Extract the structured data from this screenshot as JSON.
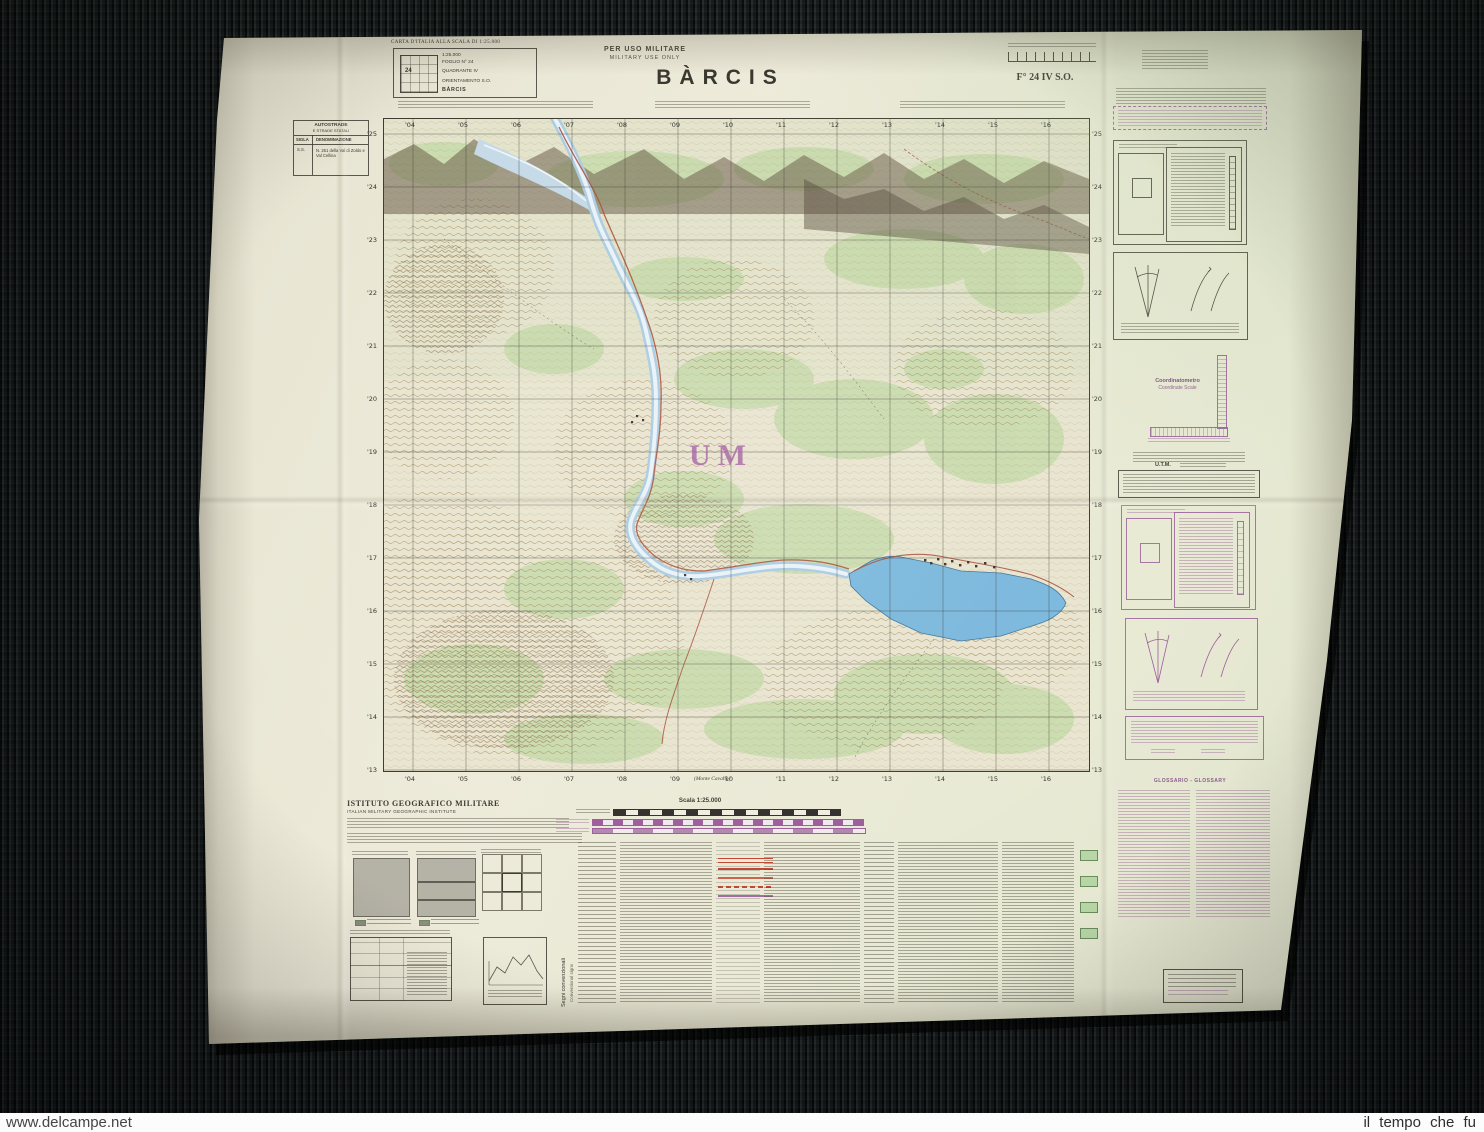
{
  "watermarks": {
    "left": "www.delcampe.net",
    "right": "il tempo che fu"
  },
  "header": {
    "carta_line": "CARTA D'ITALIA ALLA SCALA DI 1:25.000",
    "box_lines": [
      "1:25.000",
      "FOGLIO N° 24",
      "QUADRANTE IV",
      "ORIENTAMENTO S.O.",
      "BÀRCIS"
    ],
    "diagram_number": "24",
    "military_it": "PER USO MILITARE",
    "military_en": "MILITARY USE ONLY",
    "title": "BÀRCIS",
    "sheet_code": "F° 24 IV S.O."
  },
  "roads_box": {
    "title": "AUTOSTRADE",
    "subtitle": "E STRADE STATALI",
    "col1": "SIGLA",
    "col2": "DENOMINAZIONE",
    "row_sigla": "S.S.",
    "row_name": "N. 251 della Val di Zoldo e Val Cellina"
  },
  "map": {
    "zone_letters": "UM",
    "eastings": [
      "'04",
      "'05",
      "'06",
      "'07",
      "'08",
      "'09",
      "'10",
      "'11",
      "'12",
      "'13",
      "'14",
      "'15",
      "'16"
    ],
    "northings": [
      "'25",
      "'24",
      "'23",
      "'22",
      "'21",
      "'20",
      "'19",
      "'18",
      "'17",
      "'16",
      "'15",
      "'14",
      "'13"
    ],
    "adjoining_sheet": "(Monte Cavallo)"
  },
  "footer": {
    "institute_it": "ISTITUTO GEOGRAFICO MILITARE",
    "institute_en": "ITALIAN MILITARY GEOGRAPHIC INSTITUTE",
    "scale_label": "Scala 1:25.000",
    "signs_it": "Segni convenzionali",
    "signs_en": "Conventional signs"
  },
  "right_margin": {
    "coordinatometro_it": "Coordinatometro",
    "coordinatometro_en": "Coordinate Scale",
    "utm_label": "U.T.M.",
    "glossary_title": "GLOSSARIO - GLOSSARY"
  },
  "colors": {
    "paper": "#e9e6d6",
    "overprint_purple": "#9b5a9b",
    "water_blue": "#7db8dc",
    "vegetation_green": "#c3d9a6",
    "contour_brown": "#a1824f",
    "grid_ink": "#34322a",
    "road_red": "#c0432f"
  }
}
